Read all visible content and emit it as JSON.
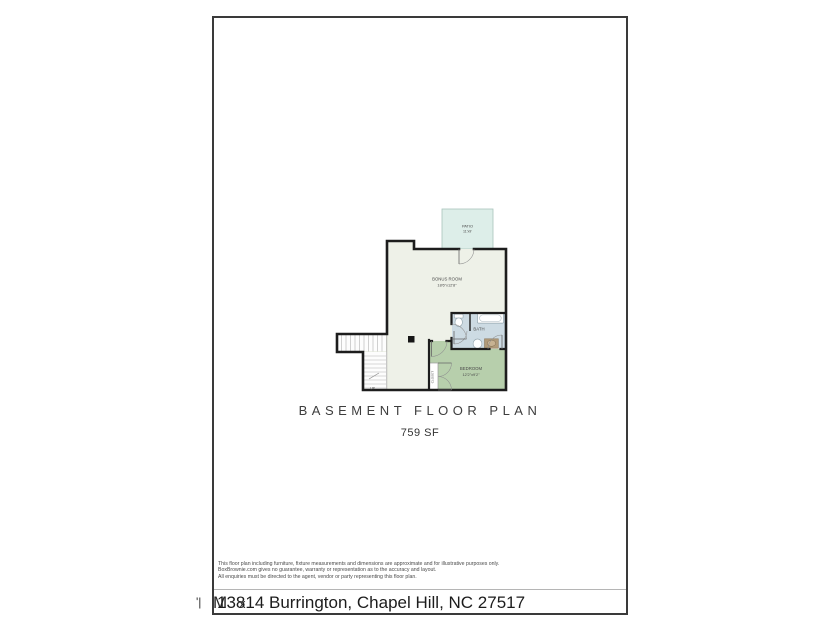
{
  "document": {
    "title": "BASEMENT FLOOR PLAN",
    "area_label": "759 SF",
    "disclaimer_lines": [
      "This floor plan including furniture, fixture measurements and dimensions are approximate and for illustrative purposes only.",
      "BoxBrownie.com gives no guarantee, warranty or representation as to the accuracy and layout.",
      "All enquiries must be directed to the agent, vendor or party representing this floor plan."
    ],
    "footer": {
      "address": "13814 Burrington, Chapel Hill, NC 27517",
      "overlap_glyph": "M",
      "overlay_glyph": "x",
      "margin_glyph": "'|"
    }
  },
  "floorplan": {
    "rooms": {
      "patio": {
        "name": "PATIO",
        "dims": "11'x9'"
      },
      "bonus": {
        "name": "BONUS ROOM",
        "dims": "18'6\"x12'8\""
      },
      "bath": {
        "name": "BATH"
      },
      "bedroom": {
        "name": "BEDROOM",
        "dims": "12'2\"x9'2\""
      },
      "closet": {
        "name": "CLOSET"
      }
    },
    "stairs": {
      "label": "UP"
    },
    "colors": {
      "wall": "#1d1d1d",
      "bonus_fill": "#eef1e8",
      "bedroom_fill": "#b7cfac",
      "bath_fill": "#cdbde3",
      "bath_fill_fix": "#cddbe3",
      "patio_fill": "#ddeee9"
    }
  }
}
